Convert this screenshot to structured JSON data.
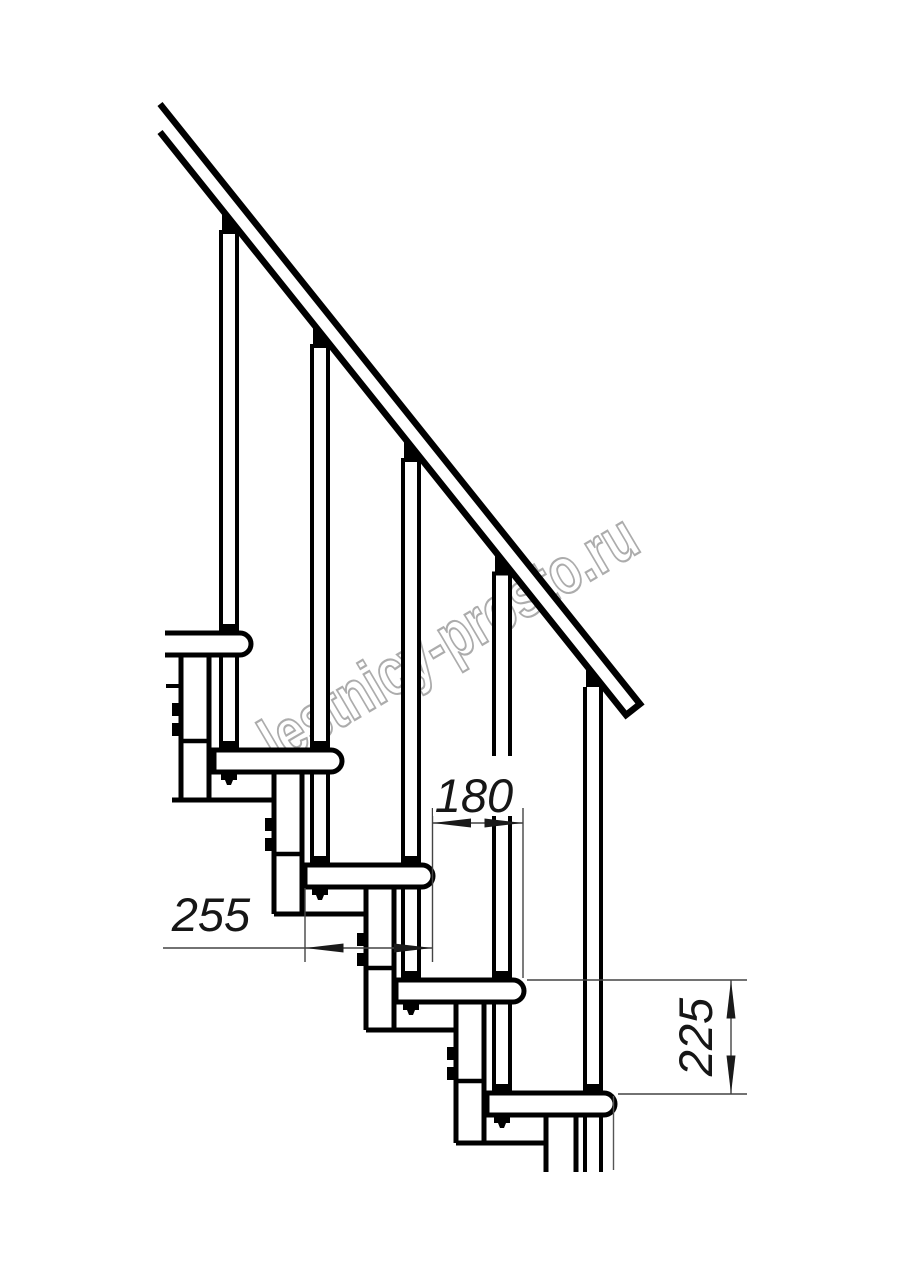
{
  "drawing": {
    "title": "modular staircase side-view fragment",
    "watermark_text": "lestnicy-prosto.ru",
    "dimensions": {
      "tread_depth": "255",
      "step_going": "180",
      "riser_height": "225"
    },
    "colors": {
      "main_line": "#000000",
      "dim_line": "#444444",
      "watermark": "#acacac",
      "background": "#ffffff"
    }
  }
}
